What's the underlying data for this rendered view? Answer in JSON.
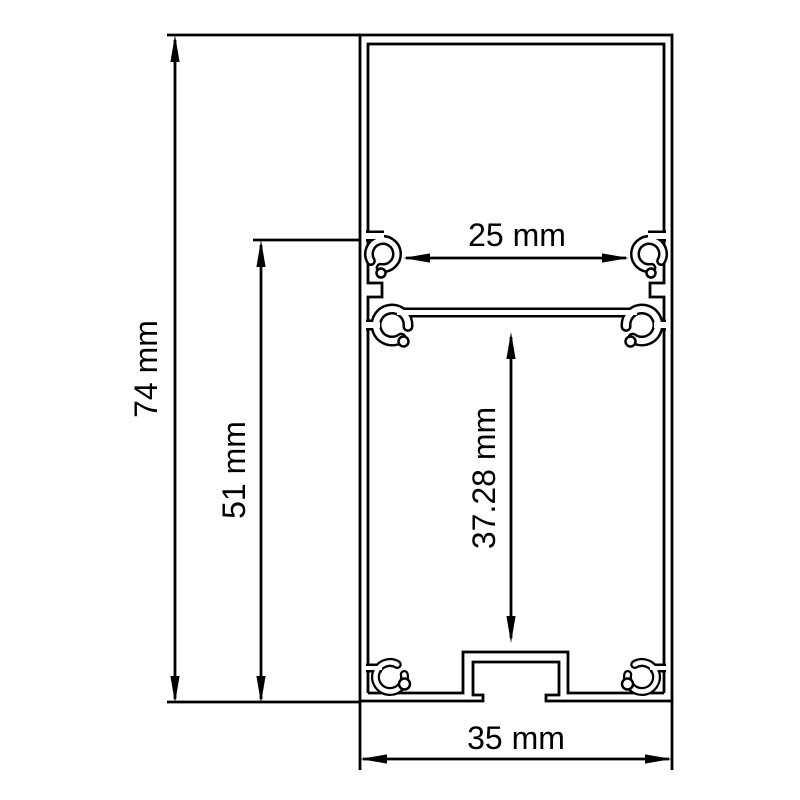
{
  "diagram": {
    "subject": "aluminium-profile-cross-section",
    "units": "mm",
    "line_color": "#000000",
    "background_color": "#ffffff",
    "dimensions": {
      "overall_height": {
        "value": 74,
        "label": "74 mm"
      },
      "upper_section_height": {
        "value": 51,
        "label": "51 mm"
      },
      "opening_width": {
        "value": 25,
        "label": "25 mm"
      },
      "inner_cavity_height": {
        "value": 37.28,
        "label": "37.28 mm"
      },
      "overall_width": {
        "value": 35,
        "label": "35 mm"
      }
    }
  }
}
